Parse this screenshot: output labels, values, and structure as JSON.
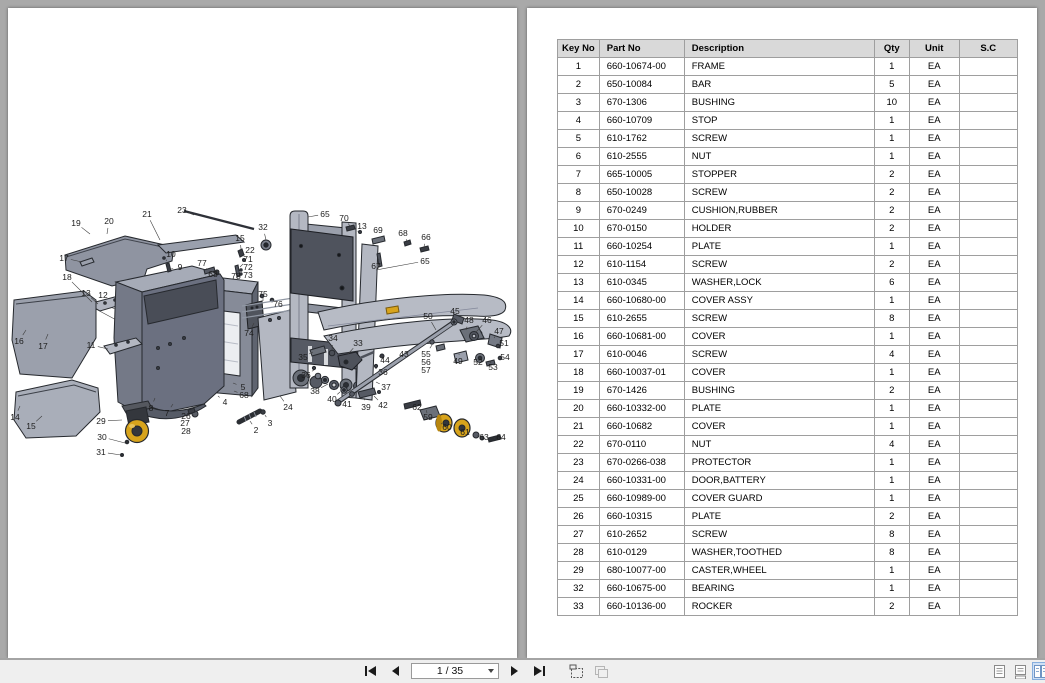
{
  "viewer": {
    "background_color": "#a9a9a9",
    "page_color": "#ffffff",
    "layout": "facing pages"
  },
  "toolbar": {
    "page_field_value": "1 / 35",
    "icons": [
      "first-page",
      "previous-page",
      "page-number-dropdown",
      "next-page",
      "last-page",
      "snapshot",
      "clipboard",
      "single-page-view",
      "continuous-view",
      "facing-page-view"
    ],
    "active_view": "facing-page-view",
    "active_view_highlight": "#cfe0f5"
  },
  "parts_table": {
    "headers": [
      "Key No",
      "Part No",
      "Description",
      "Qty",
      "Unit",
      "S.C"
    ],
    "rows": [
      [
        "1",
        "660-10674-00",
        "FRAME",
        "1",
        "EA",
        ""
      ],
      [
        "2",
        "650-10084",
        "BAR",
        "5",
        "EA",
        ""
      ],
      [
        "3",
        "670-1306",
        "BUSHING",
        "10",
        "EA",
        ""
      ],
      [
        "4",
        "660-10709",
        "STOP",
        "1",
        "EA",
        ""
      ],
      [
        "5",
        "610-1762",
        "SCREW",
        "1",
        "EA",
        ""
      ],
      [
        "6",
        "610-2555",
        "NUT",
        "1",
        "EA",
        ""
      ],
      [
        "7",
        "665-10005",
        "STOPPER",
        "2",
        "EA",
        ""
      ],
      [
        "8",
        "650-10028",
        "SCREW",
        "2",
        "EA",
        ""
      ],
      [
        "9",
        "670-0249",
        "CUSHION,RUBBER",
        "2",
        "EA",
        ""
      ],
      [
        "10",
        "670-0150",
        "HOLDER",
        "2",
        "EA",
        ""
      ],
      [
        "11",
        "660-10254",
        "PLATE",
        "1",
        "EA",
        ""
      ],
      [
        "12",
        "610-1154",
        "SCREW",
        "2",
        "EA",
        ""
      ],
      [
        "13",
        "610-0345",
        "WASHER,LOCK",
        "6",
        "EA",
        ""
      ],
      [
        "14",
        "660-10680-00",
        "COVER ASSY",
        "1",
        "EA",
        ""
      ],
      [
        "15",
        "610-2655",
        "SCREW",
        "8",
        "EA",
        ""
      ],
      [
        "16",
        "660-10681-00",
        "COVER",
        "1",
        "EA",
        ""
      ],
      [
        "17",
        "610-0046",
        "SCREW",
        "4",
        "EA",
        ""
      ],
      [
        "18",
        "660-10037-01",
        "COVER",
        "1",
        "EA",
        ""
      ],
      [
        "19",
        "670-1426",
        "BUSHING",
        "2",
        "EA",
        ""
      ],
      [
        "20",
        "660-10332-00",
        "PLATE",
        "1",
        "EA",
        ""
      ],
      [
        "21",
        "660-10682",
        "COVER",
        "1",
        "EA",
        ""
      ],
      [
        "22",
        "670-0110",
        "NUT",
        "4",
        "EA",
        ""
      ],
      [
        "23",
        "670-0266-038",
        "PROTECTOR",
        "1",
        "EA",
        ""
      ],
      [
        "24",
        "660-10331-00",
        "DOOR,BATTERY",
        "1",
        "EA",
        ""
      ],
      [
        "25",
        "660-10989-00",
        "COVER GUARD",
        "1",
        "EA",
        ""
      ],
      [
        "26",
        "660-10315",
        "PLATE",
        "2",
        "EA",
        ""
      ],
      [
        "27",
        "610-2652",
        "SCREW",
        "8",
        "EA",
        ""
      ],
      [
        "28",
        "610-0129",
        "WASHER,TOOTHED",
        "8",
        "EA",
        ""
      ],
      [
        "29",
        "680-10077-00",
        "CASTER,WHEEL",
        "1",
        "EA",
        ""
      ],
      [
        "32",
        "660-10675-00",
        "BEARING",
        "1",
        "EA",
        ""
      ],
      [
        "33",
        "660-10136-00",
        "ROCKER",
        "2",
        "EA",
        ""
      ]
    ]
  },
  "diagram": {
    "description": "Exploded parts view of pallet stacker: chassis frame, covers, battery door, caster wheel, mast with forks, rollers and fasteners",
    "colors": {
      "part_light": "#b4b8c2",
      "part_mid": "#9ba0ac",
      "part_dark": "#565a64",
      "outline": "#26292e",
      "wheel_yellow": "#d8a41c"
    },
    "callouts": [
      {
        "n": "19",
        "x": 68,
        "y": 215,
        "ex": 82,
        "ey": 226
      },
      {
        "n": "20",
        "x": 101,
        "y": 213,
        "ex": 99,
        "ey": 226
      },
      {
        "n": "21",
        "x": 139,
        "y": 206,
        "ex": 152,
        "ey": 232
      },
      {
        "n": "23",
        "x": 174,
        "y": 202,
        "ex": 186,
        "ey": 207
      },
      {
        "n": "15",
        "x": 232,
        "y": 230,
        "ex": 233,
        "ey": 241
      },
      {
        "n": "22",
        "x": 242,
        "y": 242,
        "ex": 236,
        "ey": 247
      },
      {
        "n": "71",
        "x": 240,
        "y": 251,
        "ex": 232,
        "ey": 259
      },
      {
        "n": "72",
        "x": 240,
        "y": 259
      },
      {
        "n": "73",
        "x": 240,
        "y": 267
      },
      {
        "n": "78",
        "x": 228,
        "y": 268
      },
      {
        "n": "10",
        "x": 163,
        "y": 246,
        "ex": 158,
        "ey": 253
      },
      {
        "n": "9",
        "x": 172,
        "y": 259,
        "ex": 163,
        "ey": 261
      },
      {
        "n": "77",
        "x": 194,
        "y": 255,
        "ex": 199,
        "ey": 261
      },
      {
        "n": "68",
        "x": 205,
        "y": 266,
        "ex": 208,
        "ey": 264
      },
      {
        "n": "17",
        "x": 56,
        "y": 250,
        "ex": 74,
        "ey": 254
      },
      {
        "n": "18",
        "x": 59,
        "y": 269,
        "ex": 84,
        "ey": 294
      },
      {
        "n": "13",
        "x": 78,
        "y": 285,
        "ex": 90,
        "ey": 296
      },
      {
        "n": "12",
        "x": 95,
        "y": 287,
        "ex": 98,
        "ey": 296
      },
      {
        "n": "11",
        "x": 83,
        "y": 337,
        "ex": 100,
        "ey": 341
      },
      {
        "n": "16",
        "x": 11,
        "y": 333,
        "ex": 18,
        "ey": 322
      },
      {
        "n": "17",
        "x": 35,
        "y": 338,
        "ex": 40,
        "ey": 326
      },
      {
        "n": "14",
        "x": 7,
        "y": 409,
        "ex": 12,
        "ey": 398
      },
      {
        "n": "15",
        "x": 23,
        "y": 418,
        "ex": 34,
        "ey": 408
      },
      {
        "n": "29",
        "x": 93,
        "y": 413,
        "ex": 114,
        "ey": 412
      },
      {
        "n": "30",
        "x": 94,
        "y": 429,
        "ex": 117,
        "ey": 435
      },
      {
        "n": "31",
        "x": 93,
        "y": 444,
        "ex": 113,
        "ey": 447
      },
      {
        "n": "8",
        "x": 143,
        "y": 400,
        "ex": 147,
        "ey": 390
      },
      {
        "n": "7",
        "x": 159,
        "y": 405,
        "ex": 165,
        "ey": 396
      },
      {
        "n": "26",
        "x": 178,
        "y": 408,
        "ex": 186,
        "ey": 407
      },
      {
        "n": "27",
        "x": 177,
        "y": 415
      },
      {
        "n": "28",
        "x": 178,
        "y": 423
      },
      {
        "n": "5",
        "x": 235,
        "y": 379,
        "ex": 225,
        "ey": 375
      },
      {
        "n": "68",
        "x": 236,
        "y": 387,
        "ex": 226,
        "ey": 383
      },
      {
        "n": "4",
        "x": 217,
        "y": 394,
        "ex": 210,
        "ey": 388
      },
      {
        "n": "24",
        "x": 280,
        "y": 399,
        "ex": 272,
        "ey": 388
      },
      {
        "n": "3",
        "x": 262,
        "y": 415,
        "ex": 257,
        "ey": 407
      },
      {
        "n": "2",
        "x": 248,
        "y": 422,
        "ex": 242,
        "ey": 413
      },
      {
        "n": "74",
        "x": 241,
        "y": 325,
        "ex": 246,
        "ey": 315
      },
      {
        "n": "75",
        "x": 255,
        "y": 286,
        "ex": 255,
        "ey": 290
      },
      {
        "n": "76",
        "x": 270,
        "y": 296,
        "ex": 266,
        "ey": 293
      },
      {
        "n": "32",
        "x": 255,
        "y": 219,
        "ex": 258,
        "ey": 232
      },
      {
        "n": "65",
        "x": 317,
        "y": 206,
        "ex": 300,
        "ey": 209
      },
      {
        "n": "70",
        "x": 336,
        "y": 210,
        "ex": 342,
        "ey": 218
      },
      {
        "n": "13",
        "x": 354,
        "y": 218,
        "ex": 350,
        "ey": 223
      },
      {
        "n": "69",
        "x": 370,
        "y": 222,
        "ex": 372,
        "ey": 229
      },
      {
        "n": "68",
        "x": 395,
        "y": 225,
        "ex": 399,
        "ey": 233
      },
      {
        "n": "66",
        "x": 418,
        "y": 229,
        "ex": 416,
        "ey": 239
      },
      {
        "n": "67",
        "x": 368,
        "y": 258,
        "ex": 371,
        "ey": 251
      },
      {
        "n": "65",
        "x": 417,
        "y": 253,
        "ex": 368,
        "ey": 262
      },
      {
        "n": "34",
        "x": 325,
        "y": 330,
        "ex": 324,
        "ey": 342
      },
      {
        "n": "33",
        "x": 350,
        "y": 335,
        "ex": 340,
        "ey": 346
      },
      {
        "n": "35",
        "x": 295,
        "y": 349,
        "ex": 305,
        "ey": 344
      },
      {
        "n": "36",
        "x": 298,
        "y": 367,
        "ex": 306,
        "ey": 362
      },
      {
        "n": "38",
        "x": 307,
        "y": 383,
        "ex": 320,
        "ey": 376
      },
      {
        "n": "40",
        "x": 324,
        "y": 391,
        "ex": 332,
        "ey": 384
      },
      {
        "n": "41",
        "x": 339,
        "y": 396,
        "ex": 342,
        "ey": 388
      },
      {
        "n": "39",
        "x": 358,
        "y": 399,
        "ex": 356,
        "ey": 390
      },
      {
        "n": "42",
        "x": 375,
        "y": 397,
        "ex": 366,
        "ey": 388
      },
      {
        "n": "37",
        "x": 378,
        "y": 379,
        "ex": 368,
        "ey": 374
      },
      {
        "n": "36",
        "x": 375,
        "y": 364,
        "ex": 367,
        "ey": 360
      },
      {
        "n": "44",
        "x": 377,
        "y": 352,
        "ex": 374,
        "ey": 350
      },
      {
        "n": "43",
        "x": 396,
        "y": 346,
        "ex": 392,
        "ey": 352
      },
      {
        "n": "50",
        "x": 420,
        "y": 308,
        "ex": 428,
        "ey": 322
      },
      {
        "n": "55",
        "x": 418,
        "y": 346,
        "ex": 424,
        "ey": 337
      },
      {
        "n": "56",
        "x": 418,
        "y": 354
      },
      {
        "n": "57",
        "x": 418,
        "y": 362
      },
      {
        "n": "45",
        "x": 447,
        "y": 303,
        "ex": 446,
        "ey": 311
      },
      {
        "n": "48",
        "x": 461,
        "y": 312,
        "ex": 458,
        "ey": 322
      },
      {
        "n": "46",
        "x": 479,
        "y": 312,
        "ex": 468,
        "ey": 324
      },
      {
        "n": "47",
        "x": 491,
        "y": 323,
        "ex": 486,
        "ey": 330
      },
      {
        "n": "49",
        "x": 450,
        "y": 353,
        "ex": 451,
        "ey": 347
      },
      {
        "n": "52",
        "x": 470,
        "y": 354,
        "ex": 472,
        "ey": 347
      },
      {
        "n": "51",
        "x": 496,
        "y": 335,
        "ex": 491,
        "ey": 338
      },
      {
        "n": "54",
        "x": 497,
        "y": 349,
        "ex": 493,
        "ey": 350
      },
      {
        "n": "53",
        "x": 485,
        "y": 359,
        "ex": 483,
        "ey": 355
      },
      {
        "n": "62",
        "x": 409,
        "y": 399,
        "ex": 404,
        "ey": 397
      },
      {
        "n": "59",
        "x": 420,
        "y": 409,
        "ex": 419,
        "ey": 405
      },
      {
        "n": "60",
        "x": 439,
        "y": 419,
        "ex": 434,
        "ey": 416
      },
      {
        "n": "61",
        "x": 457,
        "y": 424,
        "ex": 453,
        "ey": 420
      },
      {
        "n": "63",
        "x": 476,
        "y": 429,
        "ex": 470,
        "ey": 428
      },
      {
        "n": "64",
        "x": 493,
        "y": 429,
        "ex": 487,
        "ey": 430
      }
    ]
  }
}
